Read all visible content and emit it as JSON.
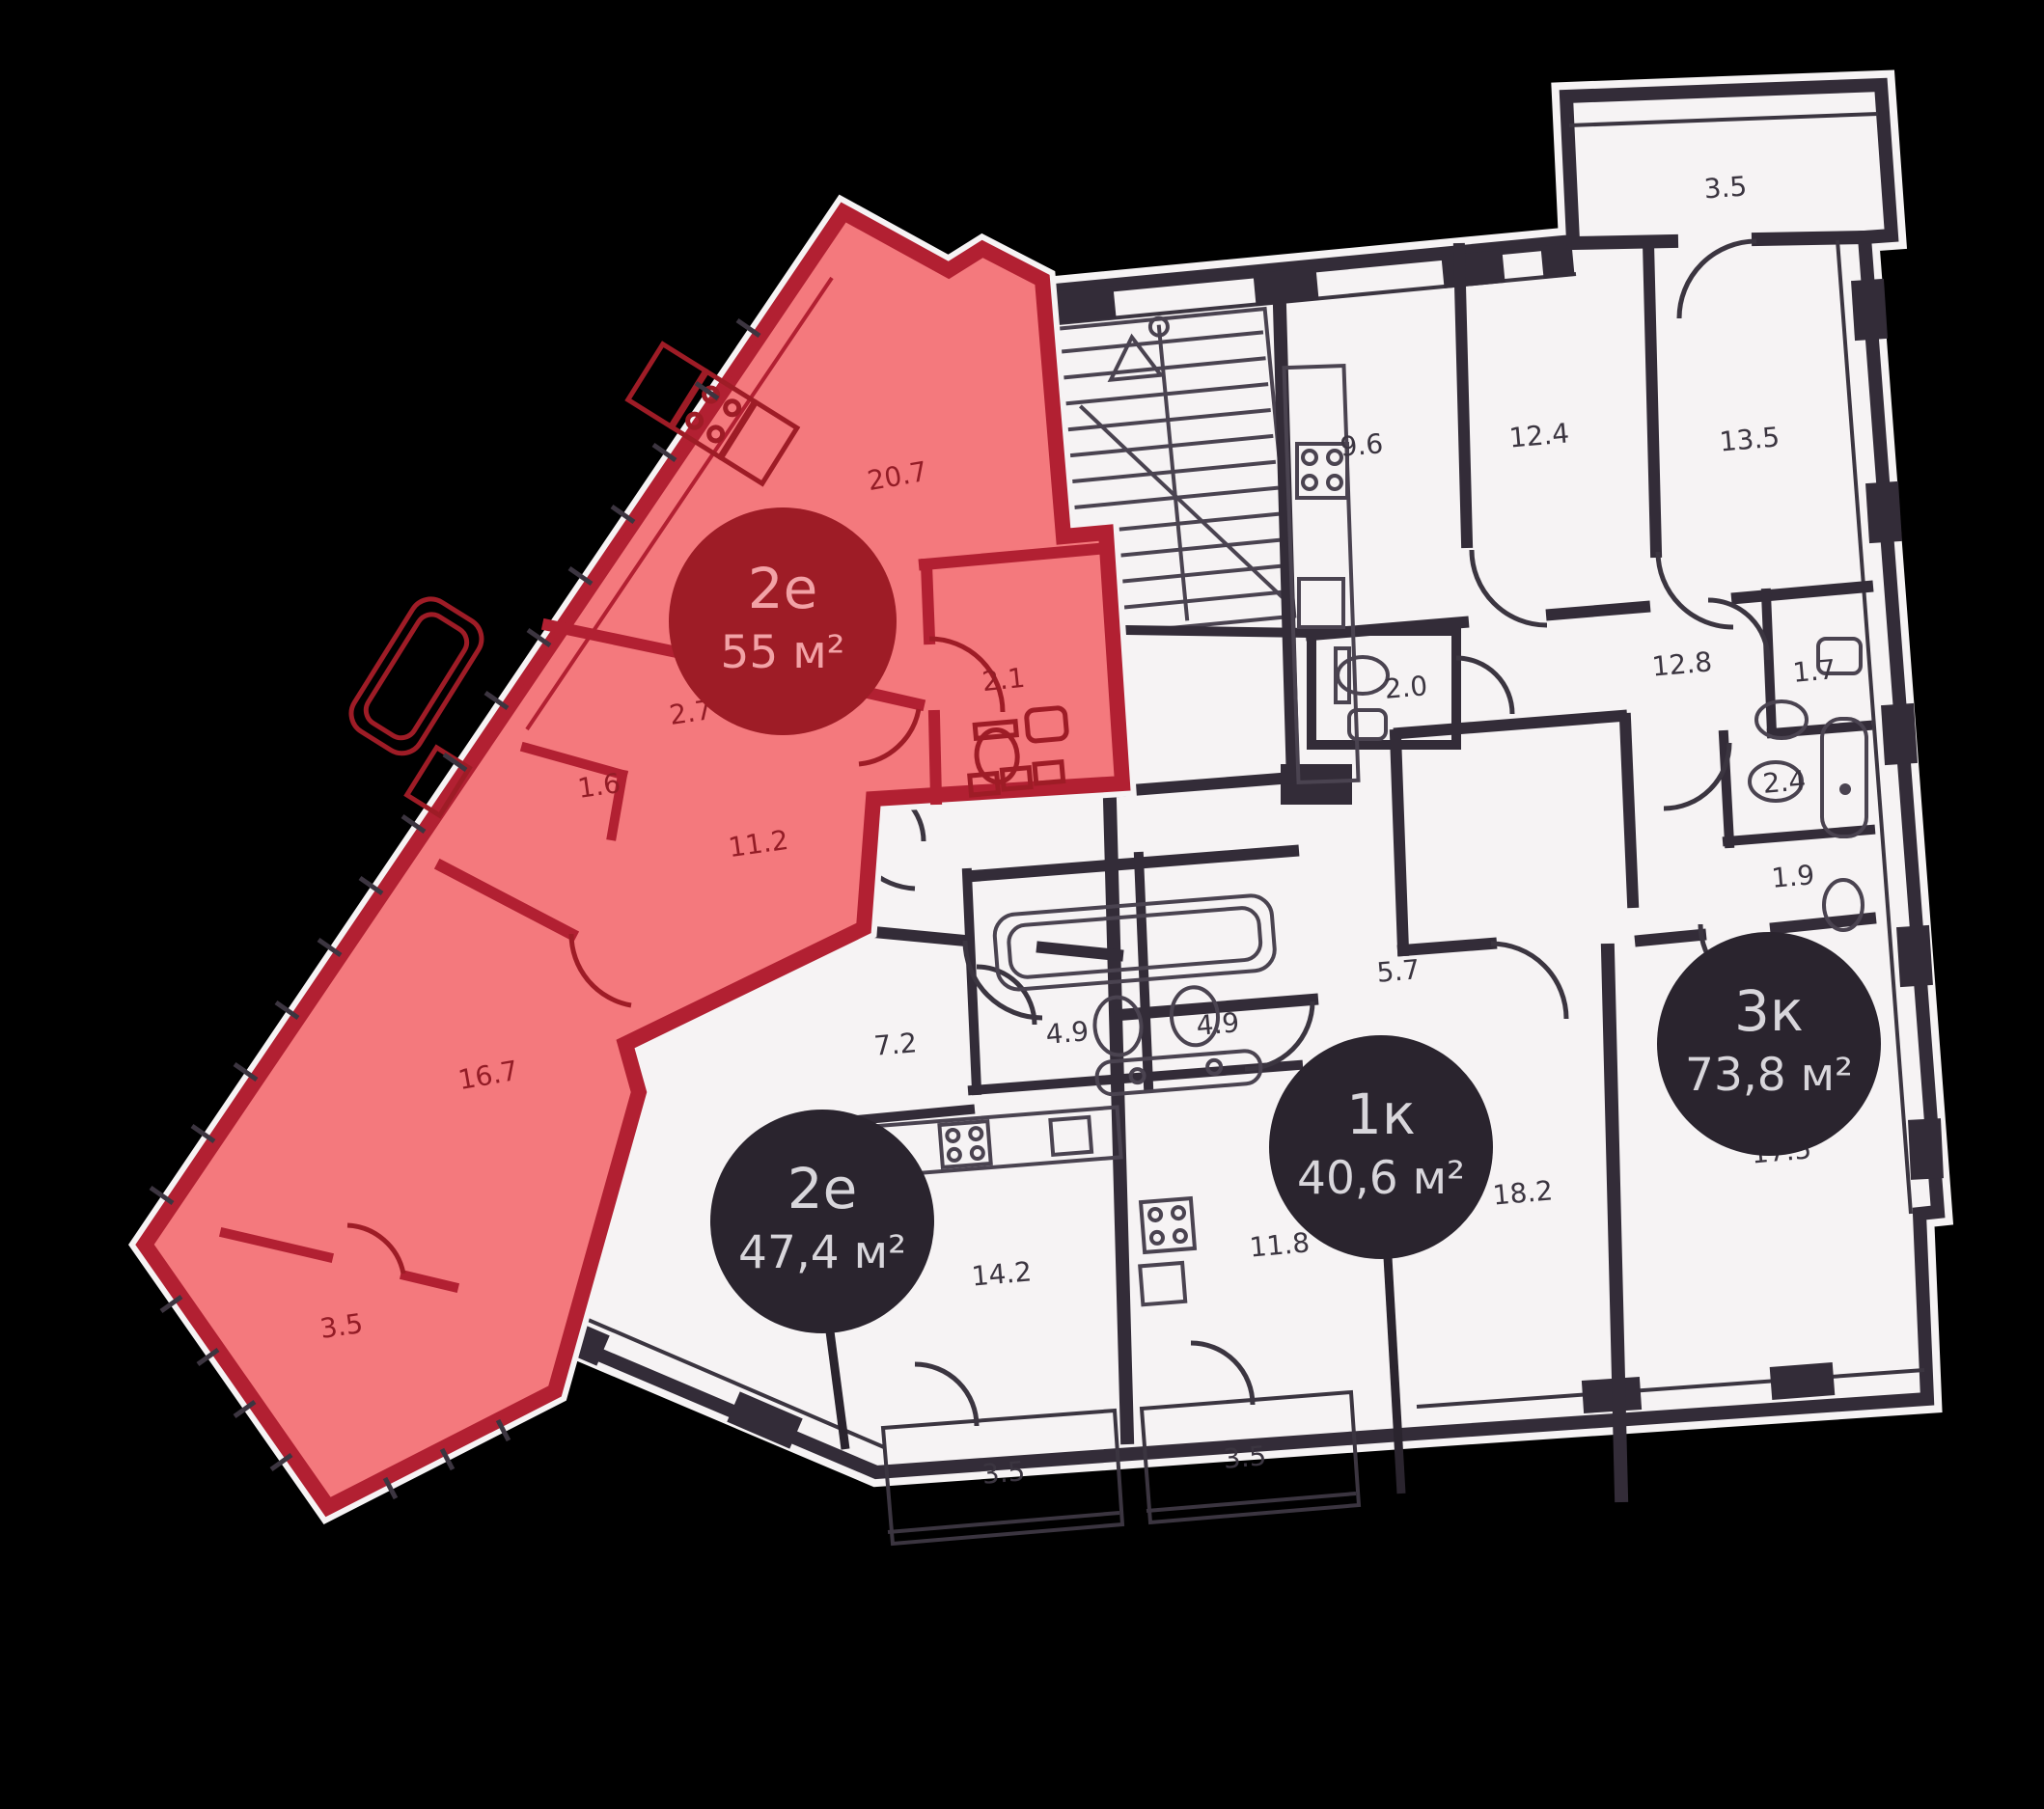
{
  "colors": {
    "background": "#000000",
    "plan_fill": "#f6f3f4",
    "wall": "#332c38",
    "label": "#3b3540",
    "highlight_fill": "#f4797d",
    "highlight_wall": "#b22032",
    "highlight_label": "#931c26",
    "highlight_badge_fill": "#9e1c26",
    "highlight_badge_text": "#f2a2a6",
    "badge_fill": "#2a242e",
    "badge_text": "#d8d6db"
  },
  "badges": [
    {
      "id": "apt-2e-55",
      "line1": "2е",
      "line2": "55 м²",
      "highlighted": true
    },
    {
      "id": "apt-2e-47",
      "line1": "2е",
      "line2": "47,4 м²",
      "highlighted": false
    },
    {
      "id": "apt-1k-40",
      "line1": "1к",
      "line2": "40,6 м²",
      "highlighted": false
    },
    {
      "id": "apt-3k-73",
      "line1": "3к",
      "line2": "73,8 м²",
      "highlighted": false
    }
  ],
  "room_labels": [
    {
      "text": "20.7"
    },
    {
      "text": "2.1"
    },
    {
      "text": "2.7"
    },
    {
      "text": "1.6"
    },
    {
      "text": "11.2"
    },
    {
      "text": "16.7"
    },
    {
      "text": "3.5"
    },
    {
      "text": "3.5"
    },
    {
      "text": "9.6"
    },
    {
      "text": "12.4"
    },
    {
      "text": "13.5"
    },
    {
      "text": "2.0"
    },
    {
      "text": "12.8"
    },
    {
      "text": "1.7"
    },
    {
      "text": "2.4"
    },
    {
      "text": "1.9"
    },
    {
      "text": "17.5"
    },
    {
      "text": "18.2"
    },
    {
      "text": "5.7"
    },
    {
      "text": "4.9"
    },
    {
      "text": "4.9"
    },
    {
      "text": "7.2"
    },
    {
      "text": "14.2"
    },
    {
      "text": "11.8"
    },
    {
      "text": "3.5"
    },
    {
      "text": "3.5"
    }
  ]
}
